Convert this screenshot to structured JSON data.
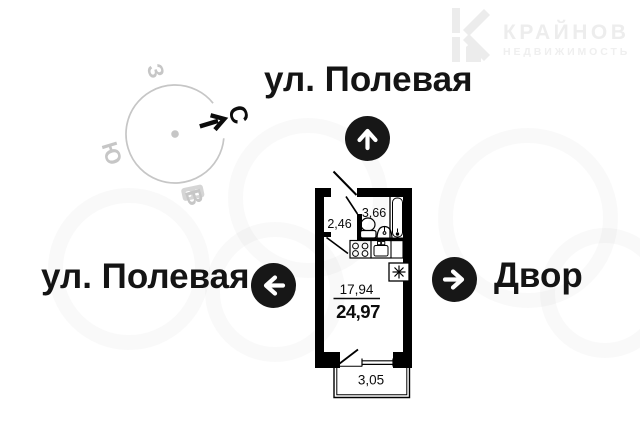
{
  "brand": {
    "name": "КРАЙНОВ",
    "subtitle": "НЕДВИЖИМОСТЬ"
  },
  "streets": {
    "top": "ул. Полевая",
    "left": "ул. Полевая",
    "right": "Двор"
  },
  "compass": {
    "north": "С",
    "east": "В",
    "south": "Ю",
    "west": "З"
  },
  "plan": {
    "hallway": "2,46",
    "bathroom": "3,66",
    "room": "17,94",
    "total": "24,97",
    "balcony": "3,05"
  },
  "colors": {
    "walls": "#000000",
    "compass_gray": "#c6c6c6",
    "text_black": "#141414",
    "logo_gray": "#ededed"
  }
}
